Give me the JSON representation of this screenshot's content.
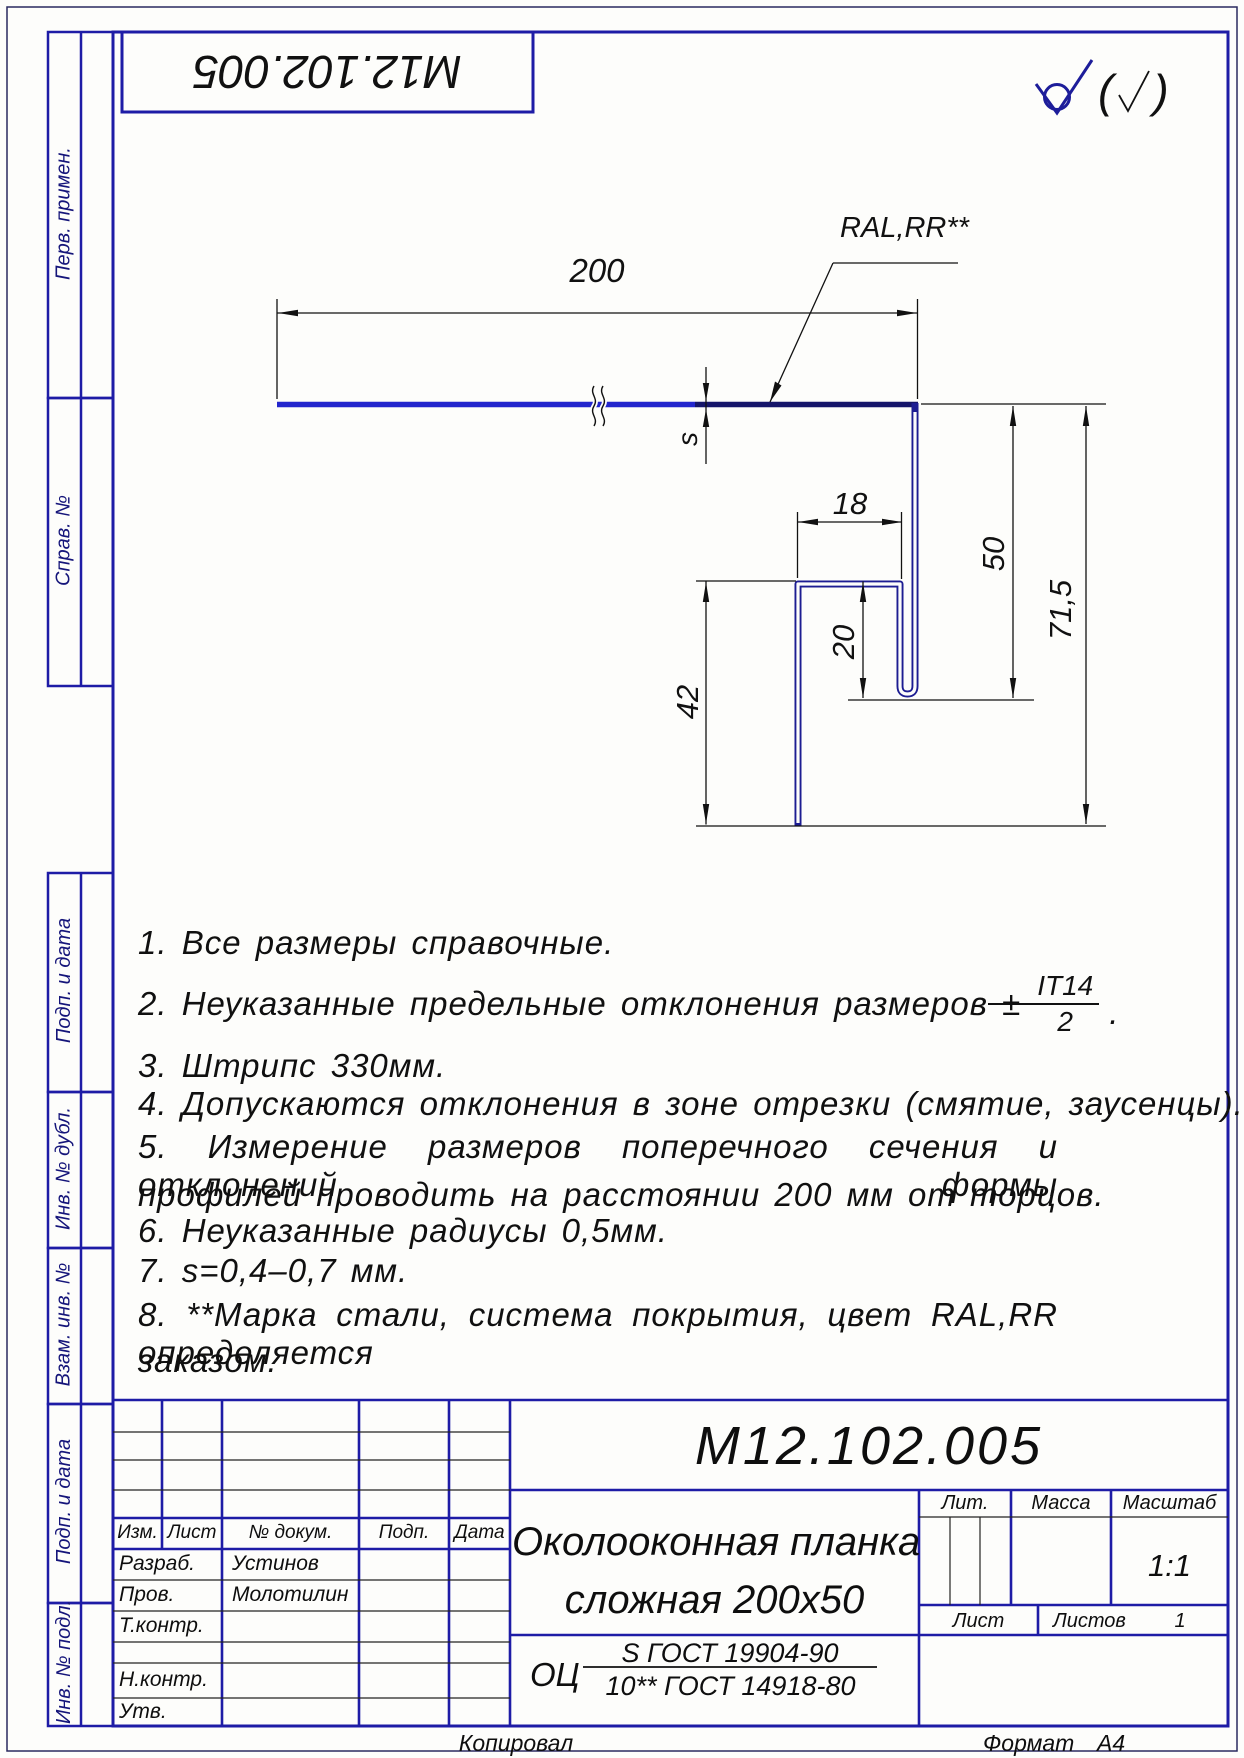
{
  "doc_box_number": "М12.102.005",
  "surface": {
    "open": "(",
    "close": ")"
  },
  "drawing": {
    "width": "200",
    "thickness": "s",
    "hook_width": "18",
    "hook_height": "20",
    "right_height": "50",
    "left_height": "42",
    "total_height": "71,5",
    "coating_label": "RAL,RR**"
  },
  "notes": [
    {
      "text": "1.  Все размеры справочные."
    },
    {
      "text": "2.  Неуказанные предельные отклонения размеров ±",
      "frac_top": "IT14",
      "frac_bottom": "2",
      "suffix": "."
    },
    {
      "text": "3.  Штрипс 330мм."
    },
    {
      "text": "4.  Допускаются отклонения в зоне отрезки (смятие, заусенцы)."
    },
    {
      "text": "5.  Измерение размеров поперечного сечения и отклонений формы",
      "text2": "профилей проводить на расстоянии 200 мм от торцов."
    },
    {
      "text": "6.  Неуказанные радиусы 0,5мм."
    },
    {
      "text": "7.  s=0,4–0,7 мм."
    },
    {
      "text": "8.  **Марка стали, система покрытия, цвет RAL,RR определяется",
      "text2": "заказом."
    }
  ],
  "margin": {
    "perv": "Перв. примен.",
    "sprav": "Справ. №",
    "podp_a": "Подп. и дата",
    "inv_dubl": "Инв. № дубл.",
    "vzam": "Взам. инв. №",
    "podp_b": "Подп. и дата",
    "inv_podl": "Инв. № подл."
  },
  "title_block": {
    "revision_headers": [
      "Изм.",
      "Лист",
      "№ докум.",
      "Подп.",
      "Дата"
    ],
    "roles": [
      {
        "label": "Разраб.",
        "name": "Устинов"
      },
      {
        "label": "Пров.",
        "name": "Молотилин"
      },
      {
        "label": "Т.контр.",
        "name": ""
      },
      {
        "label": "Н.контр.",
        "name": ""
      },
      {
        "label": "Утв.",
        "name": ""
      }
    ],
    "designation": "М12.102.005",
    "title_line1": "Околооконная планка",
    "title_line2": "сложная 200х50",
    "lit_label": "Лит.",
    "mass_label": "Масса",
    "scale_label": "Масштаб",
    "scale_value": "1:1",
    "sheet_label": "Лист",
    "sheets_label": "Листов",
    "sheets_value": "1",
    "material_prefix": "ОЦ",
    "material_top": "S ГОСТ 19904-90",
    "material_bottom": "10** ГОСТ 14918-80",
    "copied": "Копировал",
    "format_label": "Формат",
    "format_value": "А4"
  }
}
